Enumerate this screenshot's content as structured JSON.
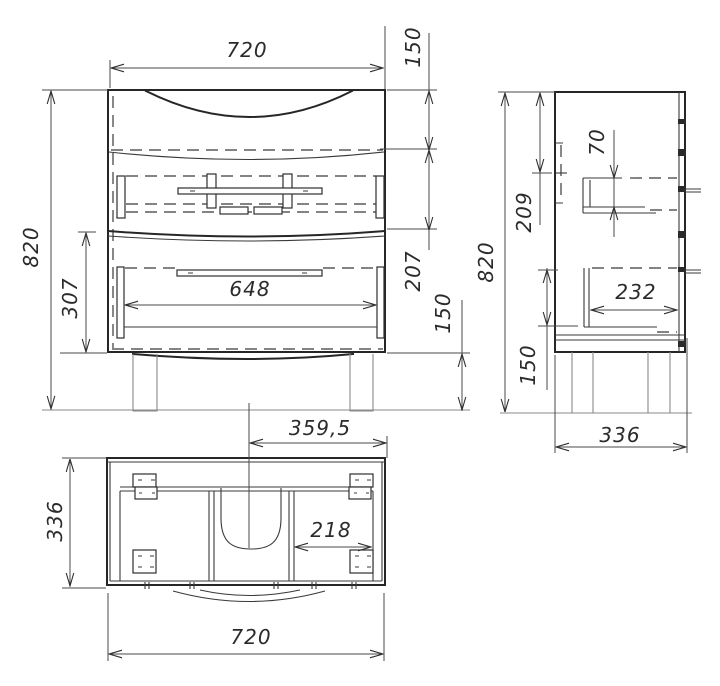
{
  "drawing": {
    "type": "technical-drawing",
    "subject": "Bathroom vanity cabinet with two drawers - orthographic projection (front, side, top views)",
    "background": "#ffffff",
    "line_color": "#262626"
  },
  "dims": {
    "front_width": "720",
    "front_height": "820",
    "front_top_section": "150",
    "front_middle_section": "207",
    "front_lower_section": "307",
    "front_drawer_inner": "648",
    "front_leg_height": "150",
    "side_height": "820",
    "side_top_offset": "209",
    "side_drawer_height": "70",
    "side_drawer_depth": "232",
    "side_lower_height": "150",
    "side_depth": "336",
    "top_depth": "336",
    "top_center_to_edge": "359,5",
    "top_compartment": "218",
    "top_width": "720"
  }
}
